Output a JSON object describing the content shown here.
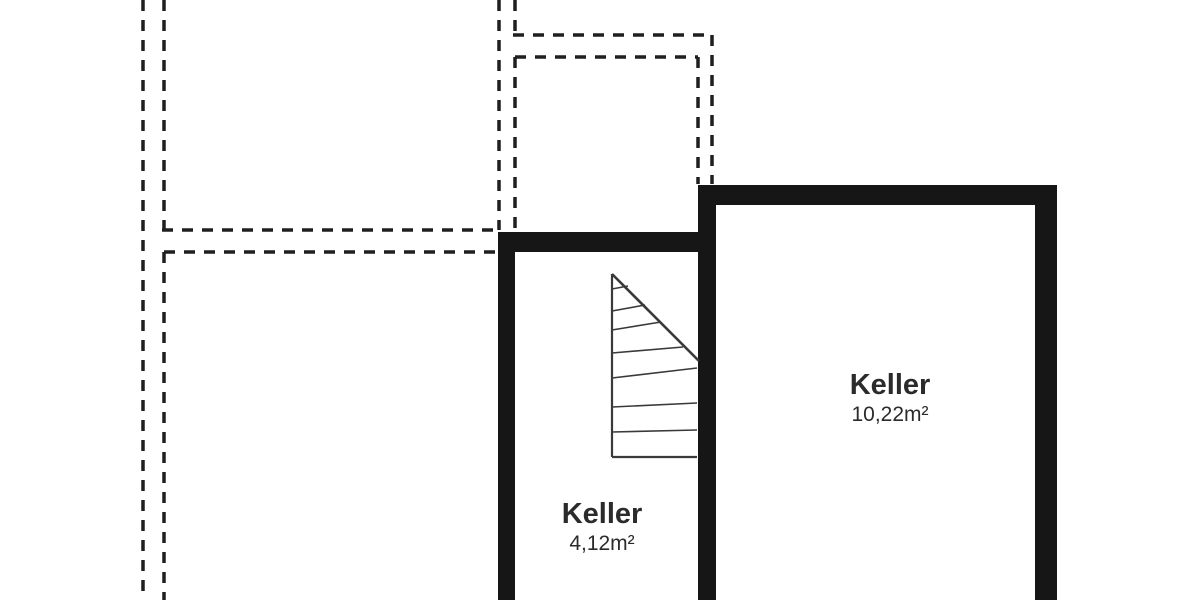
{
  "plan": {
    "type": "basement-floor-plan",
    "rooms": [
      {
        "name": "Keller",
        "area": "4,12m²"
      },
      {
        "name": "Keller",
        "area": "10,22m²"
      }
    ],
    "symbols": {
      "staircase": "winder-stair-symbol",
      "upper_floor_outline": "dashed-outline"
    },
    "colors": {
      "background": "#ffffff",
      "wall": "#161616",
      "outline": "#1f1f1f",
      "stair_line": "#3a3a3a",
      "text": "#2b2b2b"
    }
  }
}
